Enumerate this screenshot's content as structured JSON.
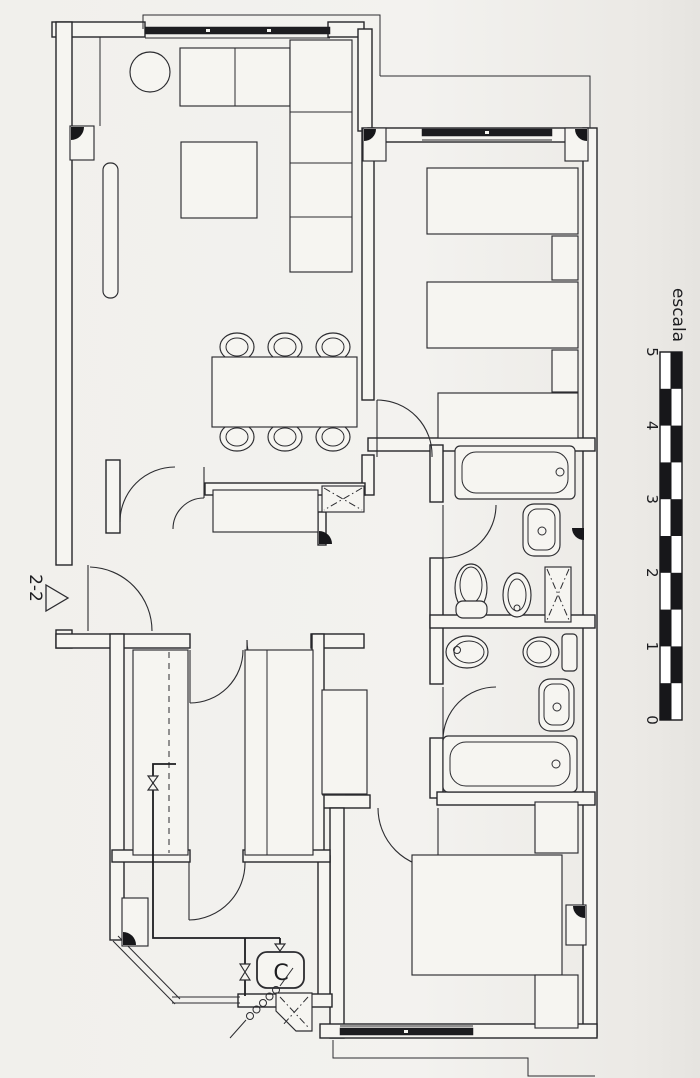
{
  "canvas": {
    "paper_color": "#f1f0ec",
    "ink_color": "#26262a"
  },
  "scale_bar": {
    "label": "escala",
    "ticks": [
      "5",
      "4",
      "3",
      "2",
      "1",
      "0"
    ],
    "orientation": "vertical",
    "segments": 10,
    "bar_colors": [
      "#ffffff",
      "#17171a"
    ]
  },
  "section_marker": {
    "label": "2-2",
    "arrow": "right-triangle-icon"
  },
  "plan": {
    "boiler_label": "C",
    "fixtures": [
      "l-sofa",
      "round-side-table",
      "coffee-table",
      "radiator",
      "dining-table",
      "dining-chairs-x6",
      "twin-bed",
      "twin-bed",
      "nightstand",
      "nightstand",
      "dresser",
      "bathtub",
      "washbasin",
      "toilet",
      "bidet",
      "vent-shaft",
      "bidet",
      "toilet",
      "washbasin",
      "bathtub",
      "double-bed",
      "nightstand",
      "nightstand",
      "kitchen-counter",
      "kitchen-counter",
      "wardrobe",
      "hall-cabinet",
      "gas-boiler",
      "gas-valve",
      "gas-valve",
      "gas-valve",
      "flex-hose-coil",
      "duct"
    ]
  }
}
